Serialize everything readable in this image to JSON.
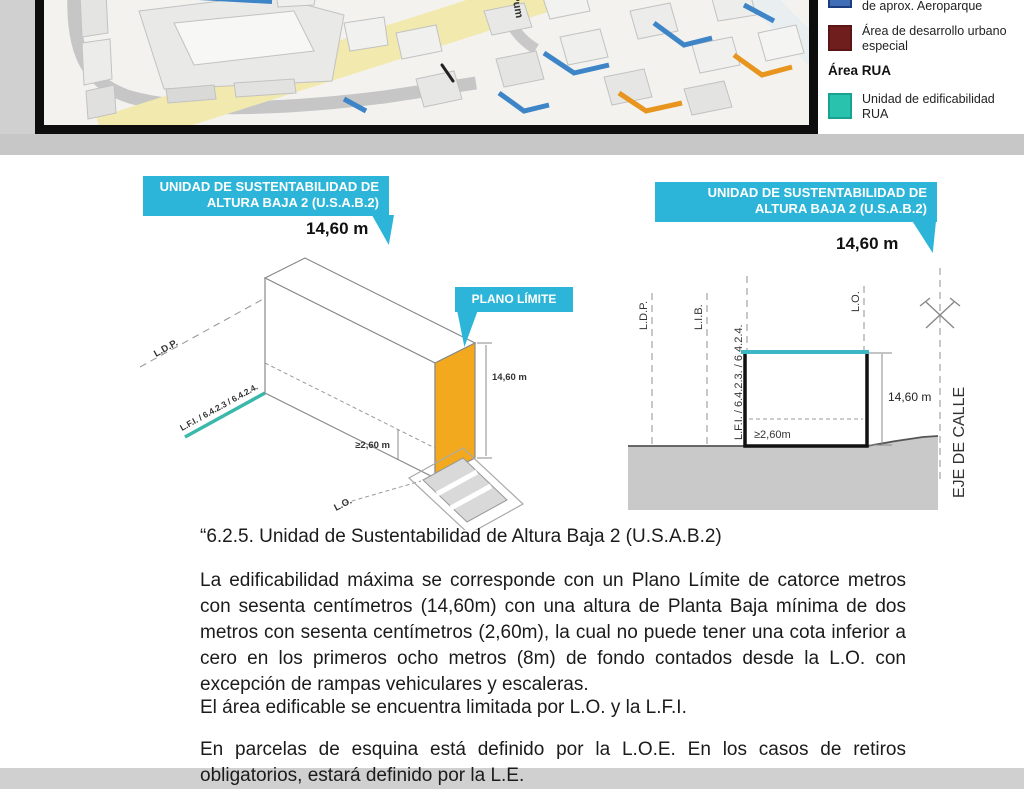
{
  "colors": {
    "cyan_bubble": "#2cb5d8",
    "orange_plane": "#f2a91e",
    "teal_parcel_line": "#3ab8ac",
    "teal_top_edge": "#3bb8c4",
    "legend_blue": "#3f6db6",
    "legend_maroon": "#701d1d",
    "legend_teal": "#29c2ac",
    "map_road_yellow": "#f1e9ad",
    "map_accent_blue": "#3d85c6",
    "map_accent_orange": "#e8951f"
  },
  "map": {
    "street_label": "Pum",
    "legend": {
      "item_aeroparque_label": "de aprox. Aeroparque",
      "item_desarrollo_line1": "Área de desarrollo urbano",
      "item_desarrollo_line2": "especial",
      "section_header": "Área RUA",
      "item_rua_line1": "Unidad de edificabilidad",
      "item_rua_line2": "RUA"
    }
  },
  "diagram_iso": {
    "title_line1": "UNIDAD DE SUSTENTABILIDAD DE",
    "title_line2": "ALTURA BAJA 2 (U.S.A.B.2)",
    "height_value": "14,60 m",
    "plano_limite": "PLANO LÍMITE",
    "label_ldp": "L.D.P.",
    "label_lfi": "L.F.I. / 6.4.2.3 / 6.4.2.4.",
    "label_lo": "L.O.",
    "dim_total": "14,60 m",
    "dim_pb": "≥2,60 m"
  },
  "diagram_section": {
    "title_line1": "UNIDAD DE SUSTENTABILIDAD DE",
    "title_line2": "ALTURA BAJA 2 (U.S.A.B.2)",
    "height_value": "14,60 m",
    "label_ldp": "L.D.P.",
    "label_lib": "L.I.B.",
    "label_lfi": "L.F.I. / 6.4.2.3. / 6.4.2.4.",
    "label_lo": "L.O.",
    "label_eje": "EJE DE CALLE",
    "dim_total": "14,60 m",
    "dim_pb": "≥2,60m"
  },
  "body_text": {
    "heading": "“6.2.5. Unidad de Sustentabilidad de Altura Baja 2 (U.S.A.B.2)",
    "para1": "La edificabilidad máxima se corresponde con un Plano Límite de catorce metros con sesenta centímetros (14,60m) con una altura de Planta Baja mínima de dos metros con sesenta centímetros (2,60m), la cual no puede tener una cota inferior a cero en los primeros ocho metros (8m) de fondo contados desde la L.O. con excepción de rampas vehiculares y escaleras.",
    "para2": "El área edificable se encuentra limitada por L.O. y la L.F.I.",
    "para3": "En parcelas de esquina está definido por la L.O.E. En los casos de retiros obligatorios, estará definido por la L.E."
  }
}
